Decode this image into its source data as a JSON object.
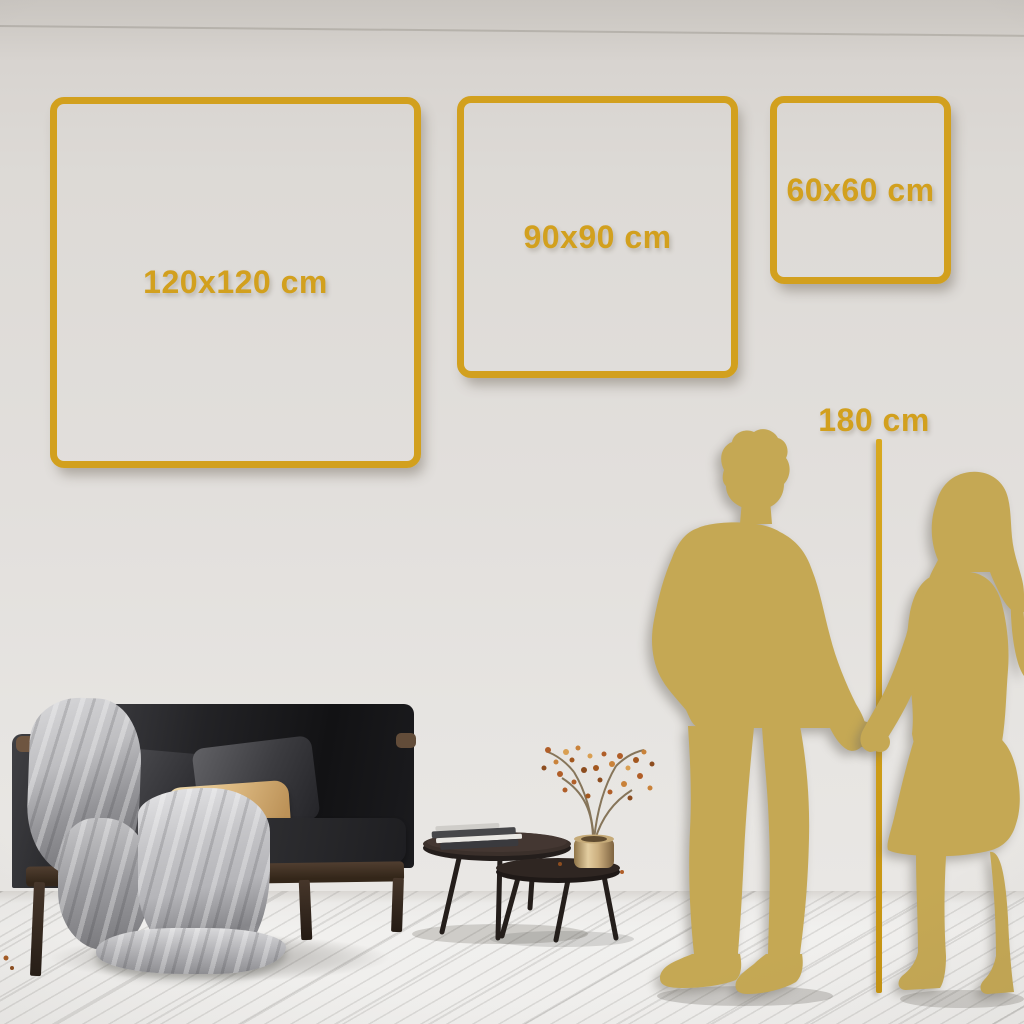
{
  "size_guide": {
    "size_options": [
      {
        "id": "120x120",
        "label": "120x120 cm"
      },
      {
        "id": "90x90",
        "label": "90x90 cm"
      },
      {
        "id": "60x60",
        "label": "60x60 cm"
      }
    ],
    "height_reference": {
      "label": "180 cm"
    }
  },
  "colors": {
    "accent_gold": "#D2A01E",
    "silhouette_gold": "#C5A854",
    "wall_top": "#C9C5C0",
    "wall_bottom": "#E9E7E4",
    "floor": "#F1F0EE",
    "sofa_dark": "#1B1B1E",
    "pillow_beige": "#DDBA82",
    "blanket_gray": "#B5B5B9",
    "wood_brown": "#46362A",
    "vase_brass": "#CDB080",
    "berry_orange": "#B05E28"
  },
  "scene_objects": [
    "gold-frame-120x120",
    "gold-frame-90x90",
    "gold-frame-60x60",
    "height-reference-line",
    "man-silhouette",
    "woman-silhouette",
    "sofa",
    "throw-blanket",
    "cushion-dark",
    "cushion-beige",
    "nesting-coffee-tables",
    "book-stack",
    "brass-vase",
    "dried-branch"
  ]
}
